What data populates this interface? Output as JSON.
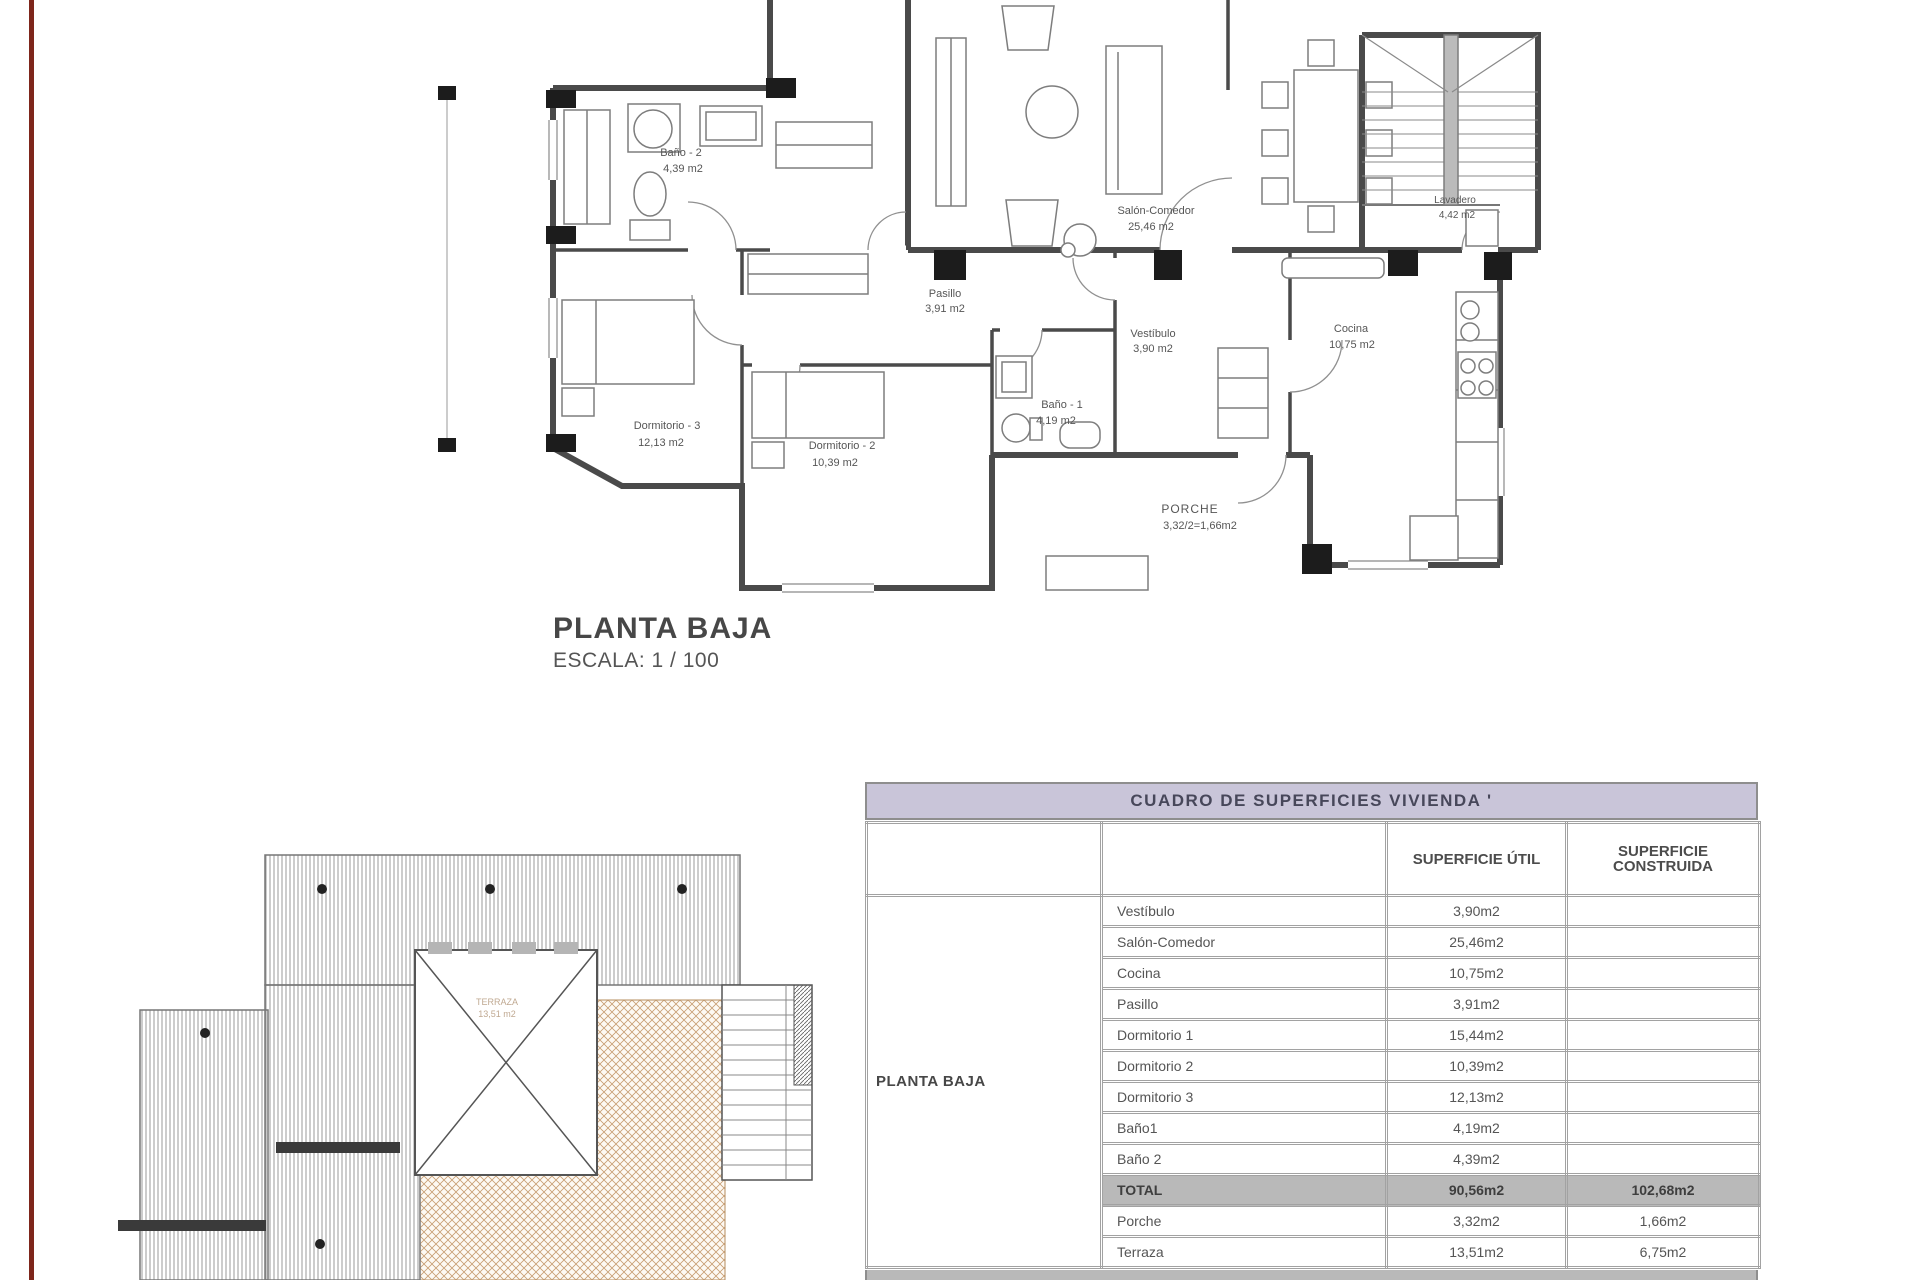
{
  "colors": {
    "margin_line": "#7e261b",
    "table_title_bg": "#c9c5d9",
    "total_row_bg": "#b9b9b9",
    "terrace_hatch": "#c79d72",
    "wall": "#4a4a4a"
  },
  "floor_plan": {
    "title": "PLANTA BAJA",
    "scale": "ESCALA: 1 / 100",
    "rooms": [
      {
        "name": "Baño - 2",
        "area": "4,39 m2"
      },
      {
        "name": "Pasillo",
        "area": "3,91 m2"
      },
      {
        "name": "Salón-Comedor",
        "area": "25,46 m2"
      },
      {
        "name": "Vestíbulo",
        "area": "3,90 m2"
      },
      {
        "name": "Cocina",
        "area": "10,75 m2"
      },
      {
        "name": "Lavadero",
        "area": "4,42 m2"
      },
      {
        "name": "Dormitorio - 3",
        "area": "12,13 m2"
      },
      {
        "name": "Dormitorio - 2",
        "area": "10,39 m2"
      },
      {
        "name": "Baño - 1",
        "area": "4,19 m2"
      },
      {
        "name": "PORCHE",
        "area": "3,32/2=1,66m2"
      }
    ]
  },
  "roof_plan": {
    "terrace_line1": "TERRAZA",
    "terrace_line2": "13,51 m2"
  },
  "table": {
    "title": "CUADRO DE SUPERFICIES  VIVIENDA '",
    "headers": {
      "util": "SUPERFICIE    ÚTIL",
      "construida": "SUPERFICIE\nCONSTRUIDA"
    },
    "section_label": "PLANTA BAJA",
    "rows": [
      {
        "name": "Vestíbulo",
        "util": "3,90m2",
        "cons": ""
      },
      {
        "name": "Salón-Comedor",
        "util": "25,46m2",
        "cons": ""
      },
      {
        "name": "Cocina",
        "util": "10,75m2",
        "cons": ""
      },
      {
        "name": "Pasillo",
        "util": "3,91m2",
        "cons": ""
      },
      {
        "name": "Dormitorio 1",
        "util": "15,44m2",
        "cons": ""
      },
      {
        "name": "Dormitorio 2",
        "util": "10,39m2",
        "cons": ""
      },
      {
        "name": "Dormitorio 3",
        "util": "12,13m2",
        "cons": ""
      },
      {
        "name": "Baño1",
        "util": "4,19m2",
        "cons": ""
      },
      {
        "name": "Baño 2",
        "util": "4,39m2",
        "cons": ""
      },
      {
        "name": "TOTAL",
        "util": "90,56m2",
        "cons": "102,68m2"
      },
      {
        "name": "Porche",
        "util": "3,32m2",
        "cons": "1,66m2"
      },
      {
        "name": "Terraza",
        "util": "13,51m2",
        "cons": "6,75m2"
      }
    ]
  }
}
